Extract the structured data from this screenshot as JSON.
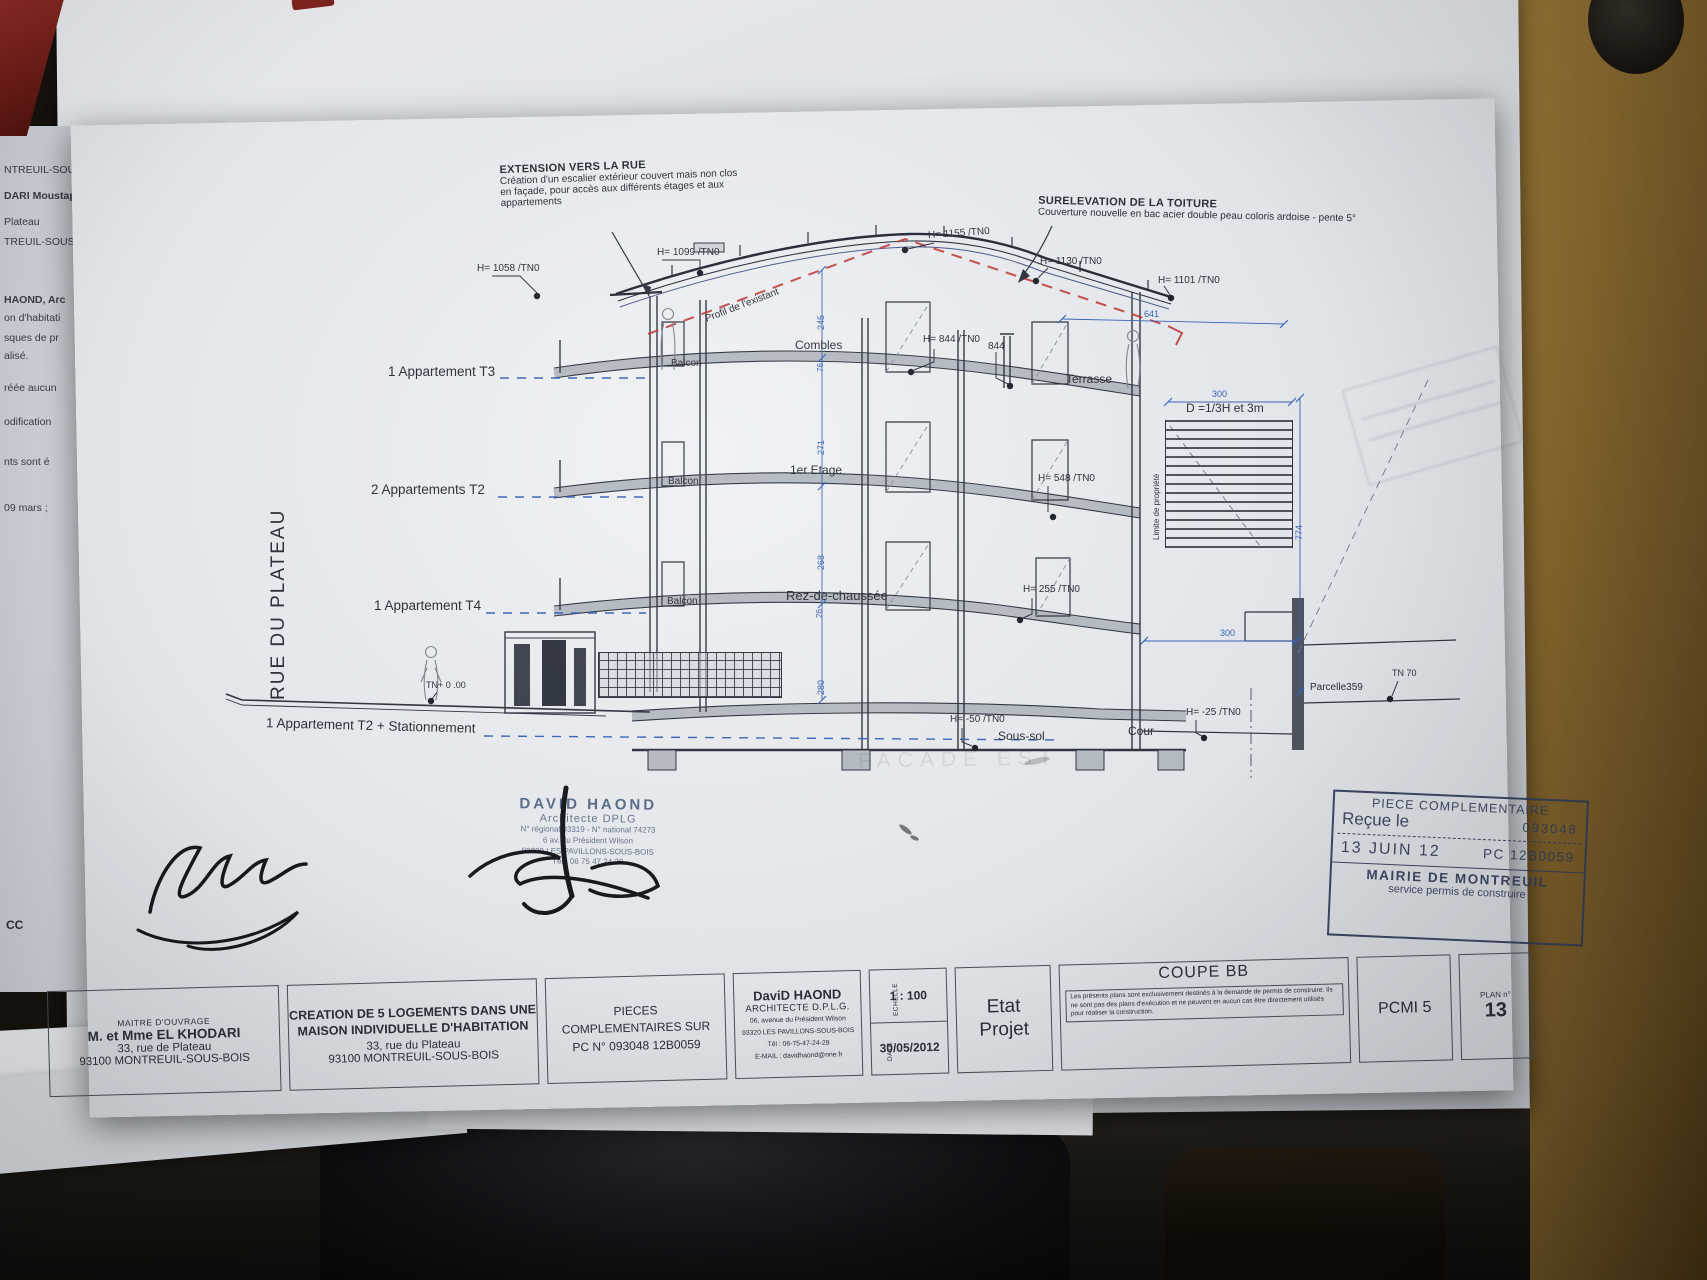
{
  "colors": {
    "dim_blue": "#3b62b8",
    "profile_red": "#bf3b38",
    "stamp_navy": "#323d58"
  },
  "street_label": "RUE DU PLATEAU",
  "apartment_labels": [
    "1 Appartement T3",
    "2 Appartements T2",
    "1 Appartement T4",
    "1 Appartement T2 + Stationnement"
  ],
  "annotations": {
    "extension": {
      "title": "EXTENSION VERS LA RUE",
      "lines": [
        "Création d'un escalier extérieur couvert mais non clos",
        "en façade,  pour accès aux différents étages et aux",
        "appartements"
      ]
    },
    "surelevation": {
      "title": "SURELEVATION DE LA TOITURE",
      "line": "Couverture nouvelle en bac acier double peau coloris ardoise - pente 5°"
    },
    "profil_existant": "Profil de l'existant",
    "limite_propriete": "Limite de propriété",
    "distance_rule": "D =1/3H et 3m",
    "parcelle": "Parcelle359",
    "ghost_text": "FACADE EST"
  },
  "rooms": {
    "combles": "Combles",
    "etage1": "1er Etage",
    "rdc": "Rez-de-chaussée",
    "soussol": "Sous-sol",
    "terrasse": "Terrasse",
    "cour": "Cour",
    "balcon": "Balcon"
  },
  "heights": {
    "h1058": "H= 1058 /TN0",
    "h1099": "H= 1099 /TN0",
    "h1155": "H= 1155 /TN0",
    "h1130": "H= 1130 /TN0",
    "h1101": "H= 1101 /TN0",
    "h844": "H= 844 /TN0",
    "v844": "844",
    "h548": "H= 548 /TN0",
    "h255": "H= 255 /TN0",
    "hm50": "H= -50 /TN0",
    "hm25": "H= -25 /TN0",
    "tn70": "TN 70",
    "tn0": "TN+ 0 .00"
  },
  "dims": {
    "d245": "245",
    "d76": "76",
    "d271": "271",
    "d268": "268",
    "d26": "26",
    "d280": "280",
    "d641": "641",
    "d774": "774",
    "d300a": "300",
    "d300b": "300"
  },
  "received_stamp": {
    "title": "PIECE COMPLEMENTAIRE",
    "recu": "Reçue le",
    "number": "093048",
    "date": "13 JUIN 12",
    "pc": "PC 12B0059",
    "mairie": "MAIRIE DE MONTREUIL",
    "service": "service permis de construire"
  },
  "architect_stamp": {
    "name": "DAVID HAOND",
    "title": "Architecte DPLG",
    "reg": "N° régional 93319 - N° national 74273",
    "addr1": "6 av. du Président Wilson",
    "addr2": "93320 LES PAVILLONS-SOUS-BOIS",
    "tel": "Tél : 06 75 47 24 29"
  },
  "title_block": {
    "owner": {
      "label": "MAITRE D'OUVRAGE",
      "name": "M. et Mme EL KHODARI",
      "addr1": "33, rue de Plateau",
      "addr2": "93100 MONTREUIL-SOUS-BOIS"
    },
    "project": {
      "line1": "CREATION DE 5 LOGEMENTS DANS UNE",
      "line2": "MAISON INDIVIDUELLE D'HABITATION",
      "addr1": "33, rue du Plateau",
      "addr2": "93100 MONTREUIL-SOUS-BOIS"
    },
    "pieces": {
      "line1": "PIECES",
      "line2": "COMPLEMENTAIRES SUR",
      "line3": "PC N° 093048 12B0059"
    },
    "architect": {
      "name": "DaviD HAOND",
      "title": "ARCHITECTE D.P.L.G.",
      "addr1": "06, avenue du Président Wilson",
      "addr2": "93320 LES PAVILLONS-SOUS-BOIS",
      "tel": "Tél : 06-75-47-24-29",
      "email": "E-MAIL : davidhaond@nne.fr"
    },
    "echelle": {
      "label": "ECHELLE",
      "value": "1 : 100"
    },
    "date": {
      "label": "DATE",
      "value": "30/05/2012"
    },
    "etat": {
      "line1": "Etat",
      "line2": "Projet"
    },
    "coupe": {
      "title": "COUPE BB",
      "disclaimer": "Les présents plans sont exclusivement destinés à la demande de permis de construire. Ils ne sont pas des plans d'exécution et ne peuvent en aucun cas être directement utilisés pour réaliser la construction."
    },
    "pcmi": "PCMI 5",
    "plan": {
      "label": "PLAN n°",
      "value": "13"
    }
  },
  "underlying_fragments": [
    "NTREUIL-SOUS-B",
    "DARI Moustaph",
    "Plateau",
    "TREUIL-SOUS-B",
    "HAOND,  Arc",
    "on d'habitati",
    "sques de pr",
    "alisé.",
    "réée aucun",
    "odification",
    "nts sont é",
    "09 mars ;",
    "CC"
  ]
}
